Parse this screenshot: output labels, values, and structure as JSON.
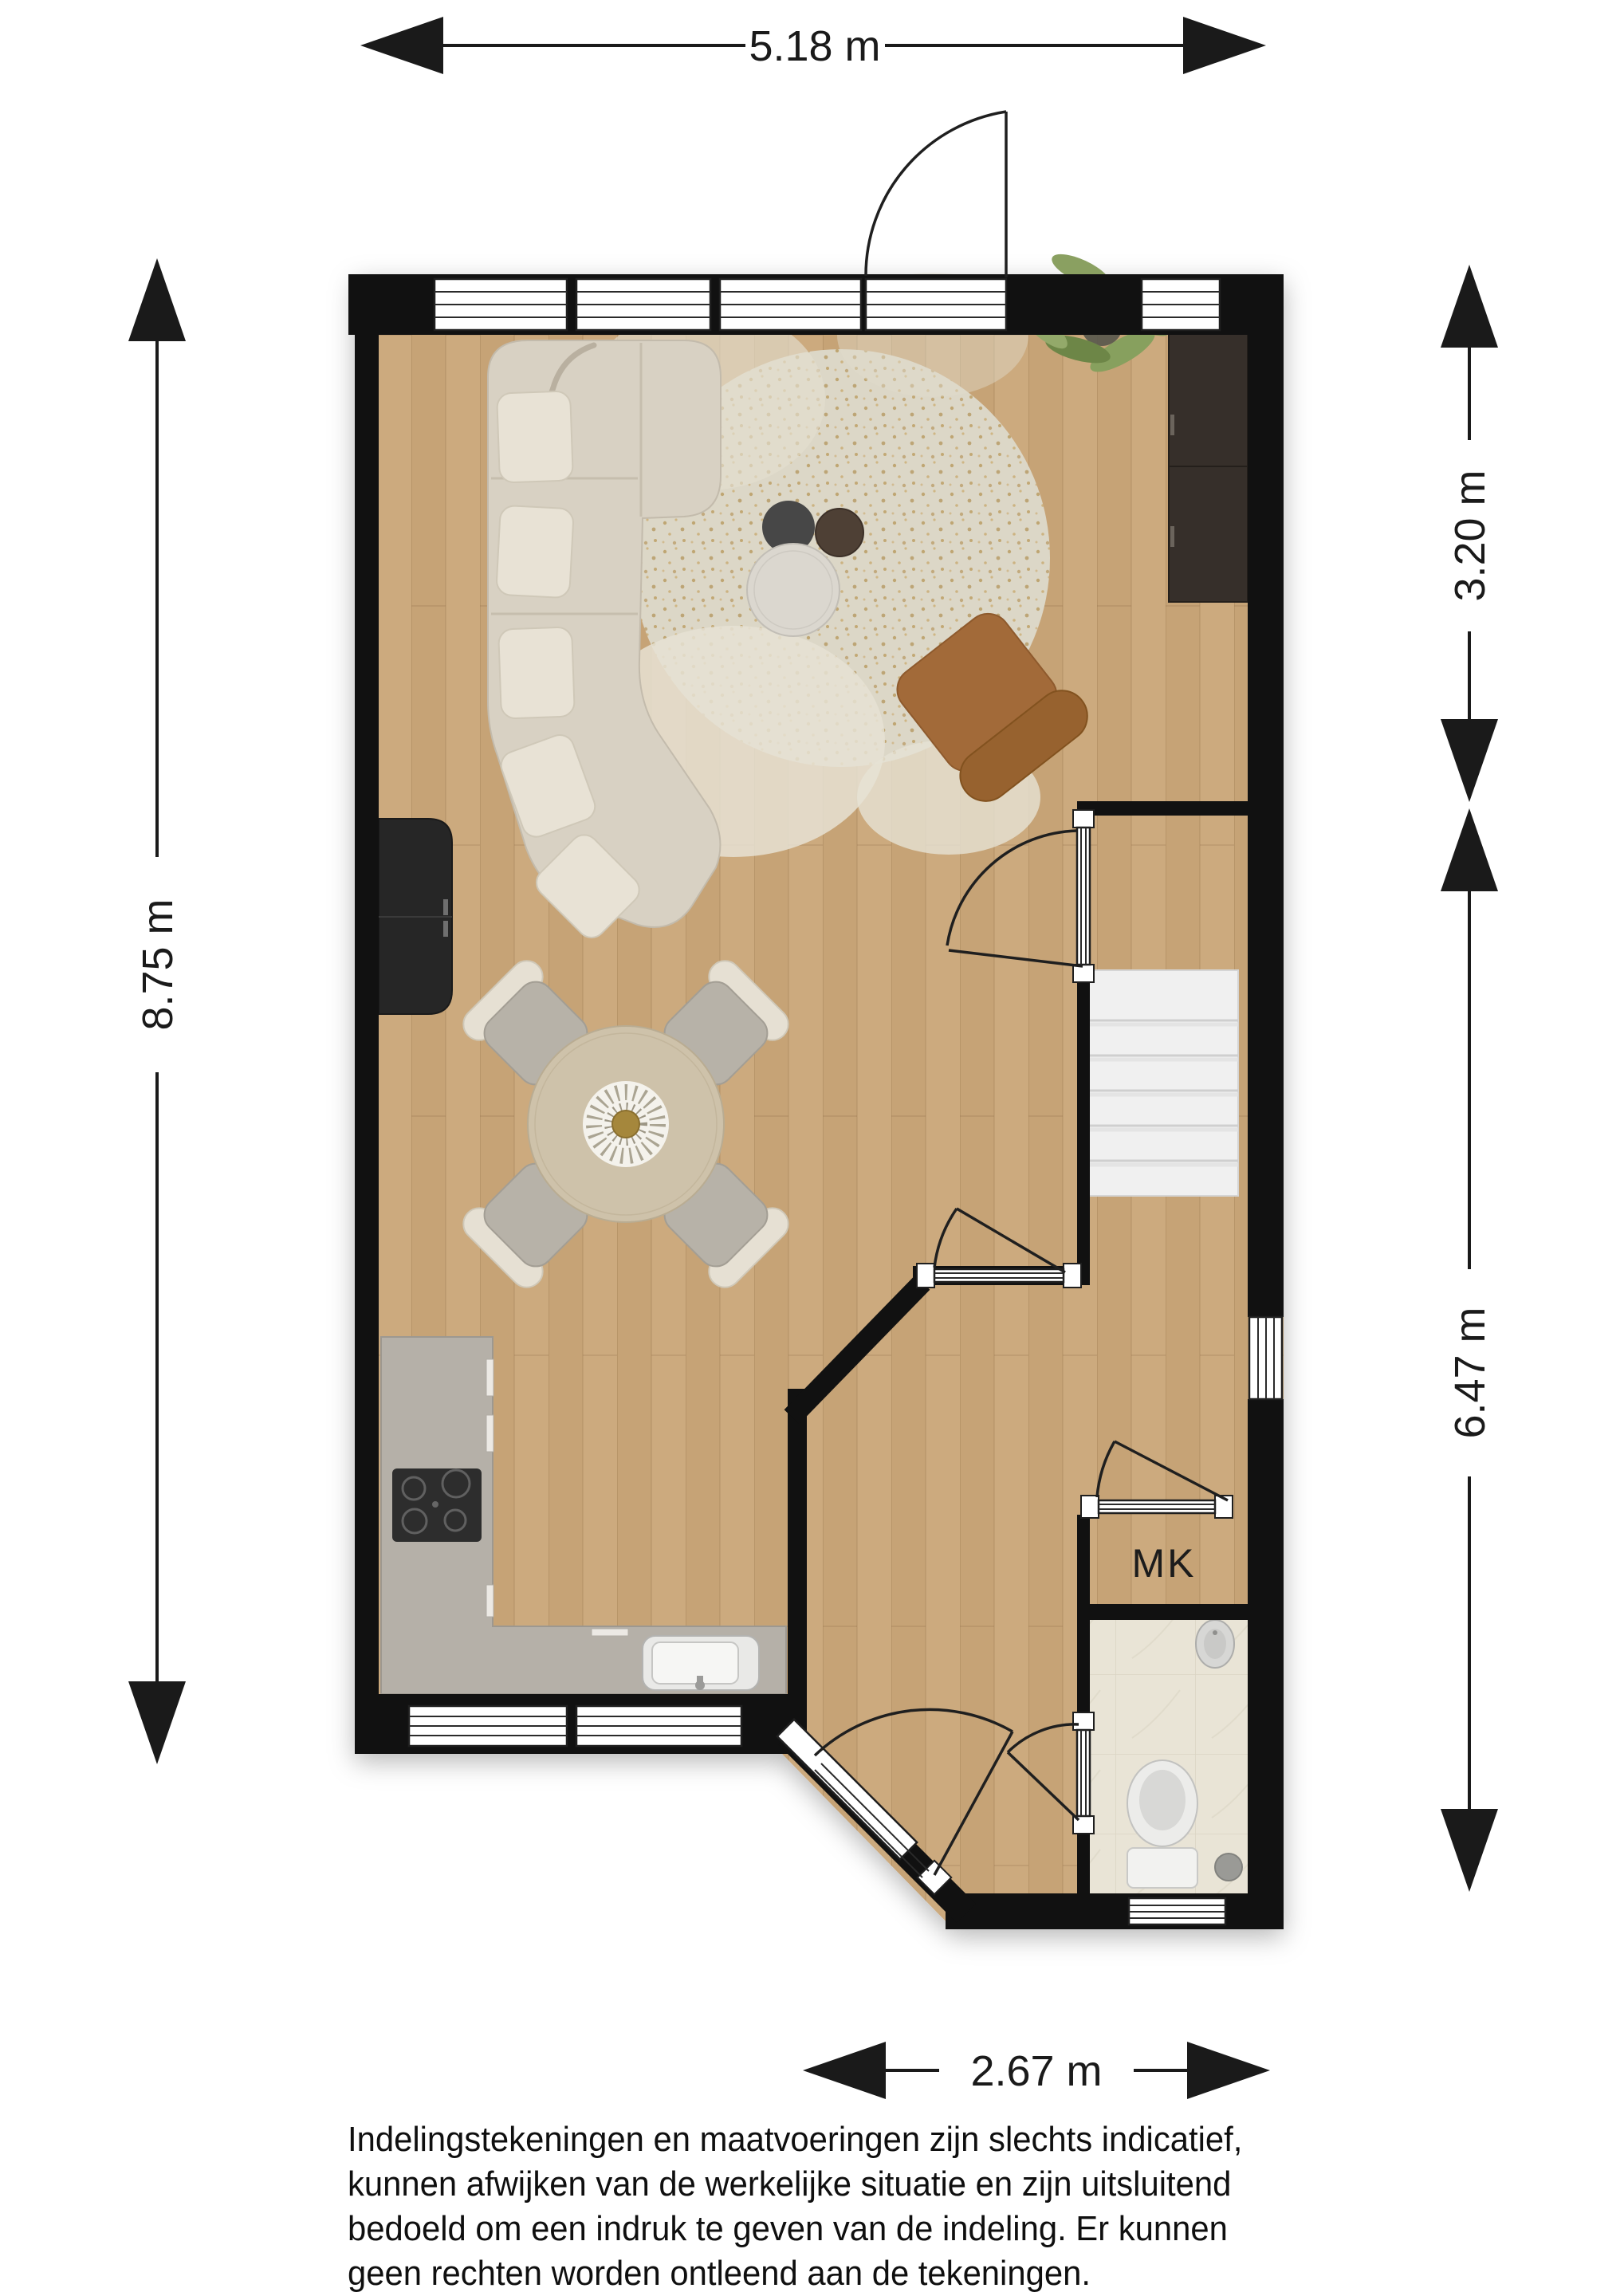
{
  "floorplan": {
    "dimensions": {
      "width_top": "5.18 m",
      "height_left": "8.75 m",
      "right_upper": "3.20 m",
      "right_lower": "6.47 m",
      "width_bottom": "2.67 m"
    },
    "labels": {
      "meter_closet": "MK"
    },
    "colors": {
      "wall": "#111111",
      "floor_wood": "#c9a77a",
      "bathroom_tile": "#e9e4d6",
      "kitchen_counter": "#b5b0a8",
      "stairs": "#f0f0f0",
      "rug": "#dcd7c7",
      "sofa": "#d8d1c3",
      "accent_chair": "#a26a39",
      "dining_table": "#cec2aa",
      "tv_cabinet": "#362f2a",
      "plant": "#7f9457"
    }
  },
  "disclaimer": {
    "lines": [
      "Indelingstekeningen en maatvoeringen zijn slechts indicatief,",
      "kunnen afwijken van de werkelijke situatie en zijn uitsluitend",
      "bedoeld om een indruk te geven van de indeling. Er kunnen",
      "geen rechten worden ontleend aan de tekeningen."
    ]
  }
}
